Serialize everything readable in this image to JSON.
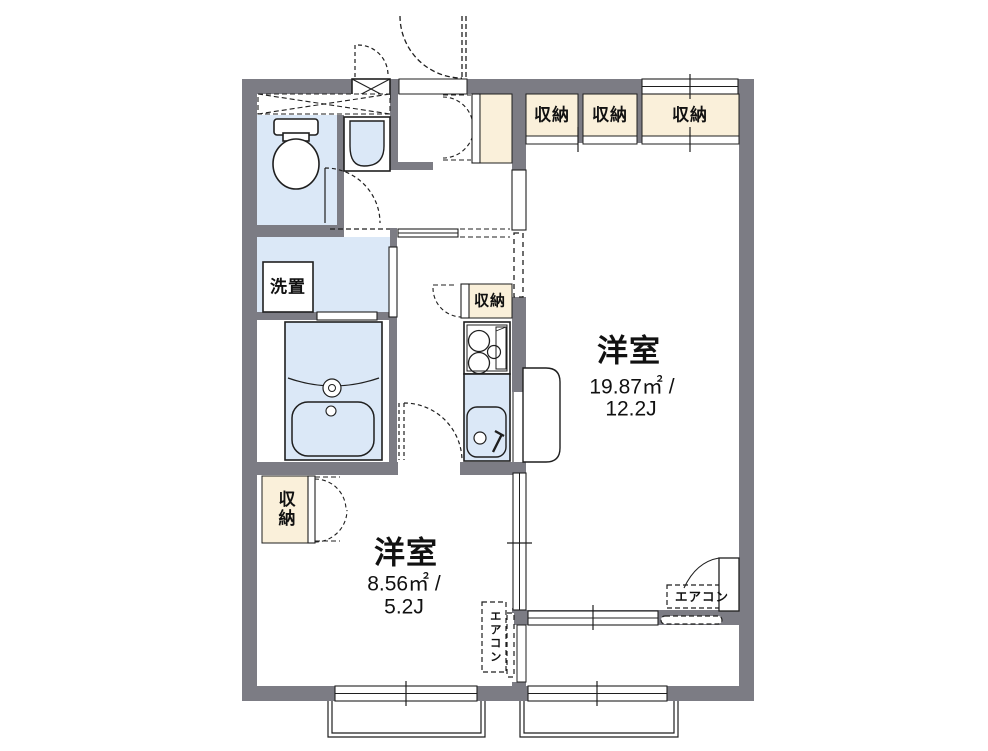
{
  "plan": {
    "rooms": {
      "large": {
        "name": "洋室",
        "area_sqm": "19.87㎡ /",
        "area_jo": "12.2J"
      },
      "small": {
        "name": "洋室",
        "area_sqm": "8.56㎡ /",
        "area_jo": "5.2J"
      }
    },
    "labels": {
      "storage": "収納",
      "washer_place": "洗置",
      "aircon": "エアコン"
    },
    "colors": {
      "wall": "#7c7c84",
      "storage_fill": "#faf0da",
      "water_fill": "#dbe8f7",
      "line": "#1f1f1f"
    }
  }
}
